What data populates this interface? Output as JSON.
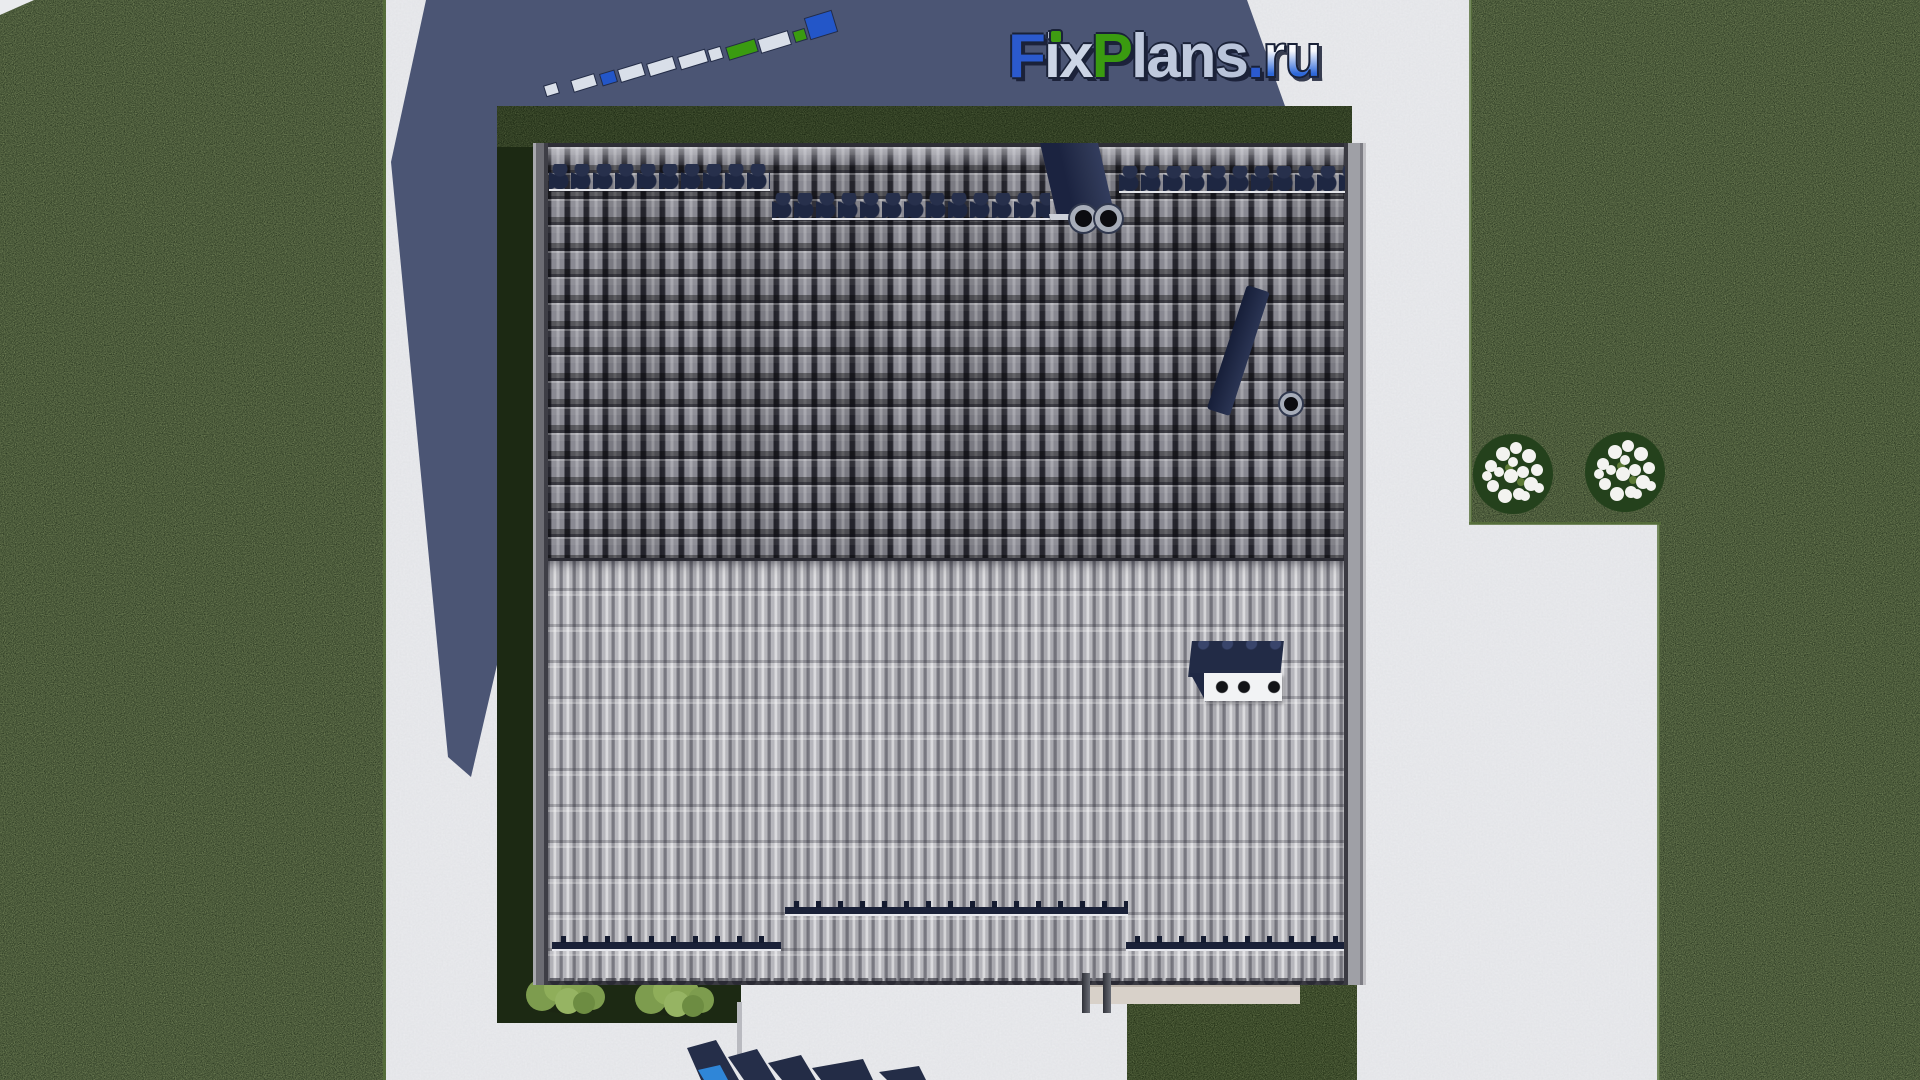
{
  "meta": {
    "width": 1920,
    "height": 1080,
    "description": "Top-down 3D render of a hip/gable house roof on a landscaped plot with lawns, concrete paths, cast shadow and FixPlans.ru watermark"
  },
  "brand": {
    "name": "FixPlans",
    "tld": ".ru",
    "full": "FixPlans.ru",
    "i_dot_color": "#3f9b12",
    "letters": [
      {
        "ch": "F",
        "color": "#2b5ace"
      },
      {
        "ch": "i",
        "color": "#ccd5e6"
      },
      {
        "ch": "x",
        "color": "#ccd5e6"
      },
      {
        "ch": "P",
        "color": "#3a9b10"
      },
      {
        "ch": "l",
        "color": "#bfc9dd"
      },
      {
        "ch": "a",
        "color": "#bfc9dd"
      },
      {
        "ch": "n",
        "color": "#bfc9dd"
      },
      {
        "ch": "s",
        "color": "#b9c4da"
      },
      {
        "ch": ".",
        "color": "#2b5ace"
      },
      {
        "ch": "r",
        "color": "#f2f5fb"
      },
      {
        "ch": "u",
        "color": "#f2f5fb"
      }
    ]
  },
  "palette": {
    "page_bg": "#eaebee",
    "shadow_blue": "#4b5574",
    "lawn_green": "#2d3b24",
    "lawn_speckle": "#6b8a3b",
    "yard_green": "#1c2913",
    "roof_upper_grey": "#83838c",
    "roof_lower_grey": "#b2b2b8",
    "trim_grey": "#76767d",
    "navy": "#222b46",
    "ornament_navy": "#27304c",
    "brand_blue": "#2356c8",
    "brand_green": "#3a9b10",
    "brand_silver": "#d9dfe9",
    "ru_top": "#f7f9fd",
    "ru_bottom": "#2e68d9",
    "outline_navy": "#1a2238",
    "watermark_navy": "#252e49",
    "watermark_blue": "#2f86d8",
    "flower_white": "#f3f3f0",
    "hedge_green": "#86a452",
    "terrace_beige": "#d8d1c9"
  }
}
